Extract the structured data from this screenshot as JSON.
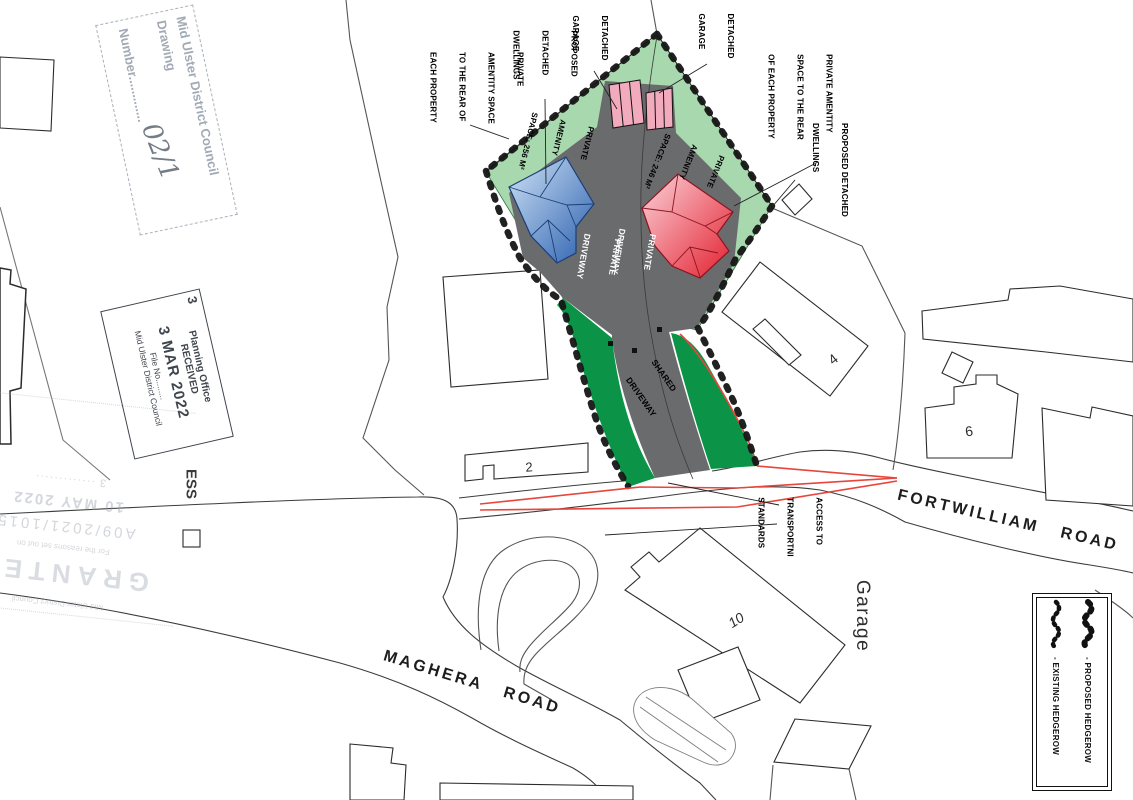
{
  "annotations": {
    "amenity_rear_left": {
      "lines": [
        "PRIVATE",
        "AMENTITY SPACE",
        "TO THE REAR OF",
        "EACH PROPERTY"
      ]
    },
    "proposed_dwellings_left": {
      "lines": [
        "PROPOSED",
        "DETACHED",
        "DWELLINGS"
      ]
    },
    "detached_garage_left": {
      "lines": [
        "DETACHED",
        "GARAGE"
      ]
    },
    "detached_garage_right": {
      "lines": [
        "DETACHED",
        "GARAGE"
      ]
    },
    "amenity_rear_right": {
      "lines": [
        "PRIVATE AMENTITY",
        "SPACE TO THE REAR",
        "OF EACH PROPERTY"
      ]
    },
    "proposed_dwellings_right": {
      "lines": [
        "PROPOSED DETACHED",
        "DWELLINGS"
      ]
    },
    "amenity_space_256": {
      "lines": [
        "PRIVATE",
        "AMENITY",
        "SPACE: 256 M²"
      ]
    },
    "amenity_space_246": {
      "lines": [
        "PRIVATE",
        "AMENITY",
        "SPACE: 246 M²"
      ]
    },
    "private_driveway_1": {
      "lines": [
        "PRIVATE",
        "DRIVEWAY"
      ]
    },
    "private_driveway_2": {
      "lines": [
        "PRIVATE",
        "DRIVEWAY"
      ]
    },
    "shared_driveway": {
      "lines": [
        "SHARED",
        "DRIVEWAY"
      ]
    },
    "access": {
      "lines": [
        "ACCESS TO",
        "TRANSPORTNI",
        "STANDARDS"
      ]
    }
  },
  "roads": {
    "fortwilliam": "FORTWILLIAM   ROAD",
    "maghera": "MAGHERA   ROAD"
  },
  "map_text": {
    "no2": "2",
    "no4": "4",
    "no6": "6",
    "no10": "10",
    "garage": "Garage",
    "ess": "ESS"
  },
  "legend": {
    "proposed": "- PROPOSED HEDGEROW",
    "existing": "- EXISTING HEDGEROW"
  },
  "stamps": {
    "drawing_number": {
      "council": "Mid Ulster District Council",
      "label": "Drawing",
      "number_label": "Number.............",
      "value": "02/1"
    },
    "received": {
      "corner_note": "3",
      "office": "Planning Office",
      "status": "RECEIVED",
      "date": "3 MAR 2022",
      "file_no": "File No.........",
      "council": "Mid Ulster District Council"
    },
    "granted": {
      "council": "Mid Ulster District Council",
      "status": "GRANTED",
      "reason": "For the reasons set out on",
      "reference": "A09/2021/1015",
      "date": "10 MAY 2022",
      "note": "3 ·············"
    }
  },
  "colors": {
    "amenity_green": "#a8d8ae",
    "strip_green": "#0b9447",
    "driveway_grey": "#6a6b6d",
    "garage_pink": "#f2aabd",
    "dwelling_blue_dark": "#2a5fae",
    "dwelling_blue_light": "#cfe3f6",
    "dwelling_red_dark": "#e31e2d",
    "dwelling_red_light": "#fbd3da",
    "sightline_red": "#e8453c",
    "hedge_black": "#161616",
    "line_grey": "#3c3c3c"
  }
}
